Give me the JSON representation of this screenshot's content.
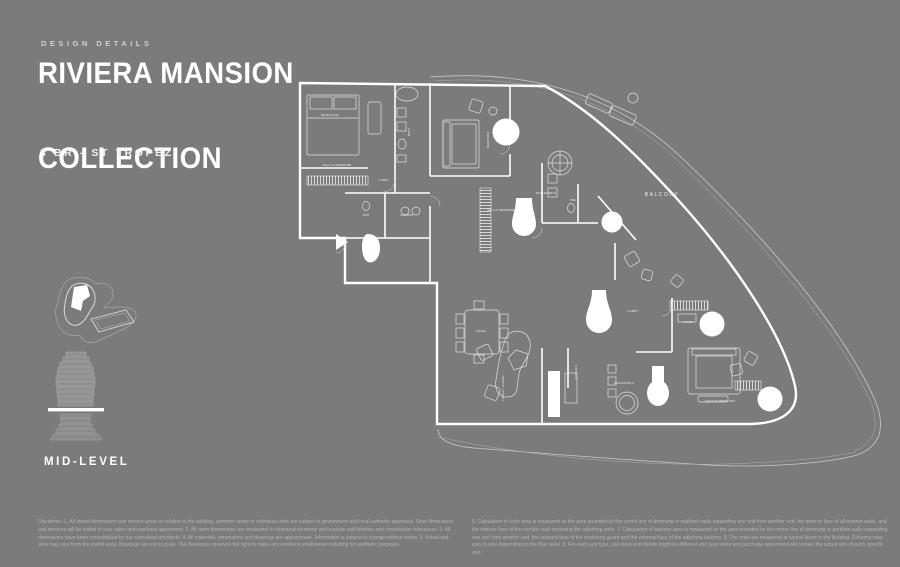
{
  "page": {
    "background_color": "#7b7b7b",
    "line_color": "#ffffff"
  },
  "header": {
    "eyebrow": "DESIGN DETAILS",
    "title_line1": "RIVIERA MANSION",
    "title_line2": "COLLECTION",
    "subtitle": "3 BR - ST TROPEZ"
  },
  "sidebar": {
    "site_plan_icon": "site-plan-icon",
    "building_icon": "building-level-icon",
    "level_label": "MID-LEVEL"
  },
  "floorplan": {
    "name": "3 BR - St Tropez mid-level floor plan",
    "labels": [
      {
        "text": "BALCONY",
        "x": 382,
        "y": 148,
        "size": 5,
        "ls": 1.5,
        "rot": 0
      },
      {
        "text": "BEDROOM",
        "x": 50,
        "y": 68,
        "size": 3,
        "ls": 0.3,
        "rot": 0
      },
      {
        "text": "BATH",
        "x": 130,
        "y": 84,
        "size": 2.8,
        "ls": 0.3,
        "rot": -90
      },
      {
        "text": "WALK-IN WARDROBE",
        "x": 57,
        "y": 118,
        "size": 2.5,
        "ls": 0.2,
        "rot": 0
      },
      {
        "text": "LOBBY",
        "x": 104,
        "y": 133,
        "size": 2.8,
        "ls": 0.3,
        "rot": 0
      },
      {
        "text": "PWD",
        "x": 86,
        "y": 168,
        "size": 2.5,
        "ls": 0.2,
        "rot": 0
      },
      {
        "text": "LAUNDRY",
        "x": 127,
        "y": 168,
        "size": 2.5,
        "ls": 0.2,
        "rot": 0
      },
      {
        "text": "FOYER",
        "x": 96,
        "y": 207,
        "size": 2.5,
        "ls": 0.2,
        "rot": -90
      },
      {
        "text": "BEDROOM",
        "x": 209,
        "y": 92,
        "size": 2.8,
        "ls": 0.3,
        "rot": -90
      },
      {
        "text": "MASTER BATH",
        "x": 266,
        "y": 146,
        "size": 2.6,
        "ls": 0.2,
        "rot": 0
      },
      {
        "text": "PWD",
        "x": 293,
        "y": 153,
        "size": 2.4,
        "ls": 0.2,
        "rot": 0
      },
      {
        "text": "WALK IN WARDROBE",
        "x": 221,
        "y": 163,
        "size": 2.4,
        "ls": 0.2,
        "rot": 0
      },
      {
        "text": "LOBBY",
        "x": 353,
        "y": 264,
        "size": 2.8,
        "ls": 0.3,
        "rot": 0
      },
      {
        "text": "STORE",
        "x": 408,
        "y": 275,
        "size": 2.6,
        "ls": 0.2,
        "rot": 0
      },
      {
        "text": "KITCHEN",
        "x": 297,
        "y": 324,
        "size": 2.8,
        "ls": 0.3,
        "rot": -90
      },
      {
        "text": "MASTER BATH",
        "x": 344,
        "y": 336,
        "size": 2.5,
        "ls": 0.2,
        "rot": 0
      },
      {
        "text": "MASTER BEDROOM",
        "x": 440,
        "y": 354,
        "size": 2.8,
        "ls": 0.2,
        "rot": 0
      },
      {
        "text": "LIVING / DINING",
        "x": 224,
        "y": 340,
        "size": 2.8,
        "ls": 0.3,
        "rot": -90
      },
      {
        "text": "DINING",
        "x": 201,
        "y": 284,
        "size": 2.5,
        "ls": 0.2,
        "rot": 0
      }
    ]
  },
  "disclaimer": {
    "left": "Disclaimer: 1. All stated dimensions and service areas in relation to the building, common areas or individual units are subject to government and local authority approvals. Final dimensions and services will be stated in your sales and purchase agreement. 2. All room dimensions are measured to structural elements and exclude wall finishes and construction tolerances. 3. All dimensions have been consolidated by our consultant architects. 4. All materials, dimensions and drawings are approximate. Information is subject to change without notice. 5. Actual unit area may vary from the stated area. Drawings are not to scale. The Developer reserves the right to make any revisions whatsoever including for aesthetic purposes.",
    "right": "6. Calculation of units area is measured as the area bounded by the centre line of demising or wall/unit walls separating one unit from another unit, the exterior face of all exterior walls, and the exterior face of the corridor wall enclosing the adjoining units. 7. Calculation of balcony area is measured as the area bounded by the centre line of demising or partition walls separating one unit from another unit, the outward face of the enclosing guard and the external face of the adjoining balcony. 8. The units are measured at typical floors in the building. Columns may vary in size depending on the floor level. 9. For each unit type, unit sizes and details might be different and your sales and purchase agreement will contain the actual size of each specific unit."
  }
}
